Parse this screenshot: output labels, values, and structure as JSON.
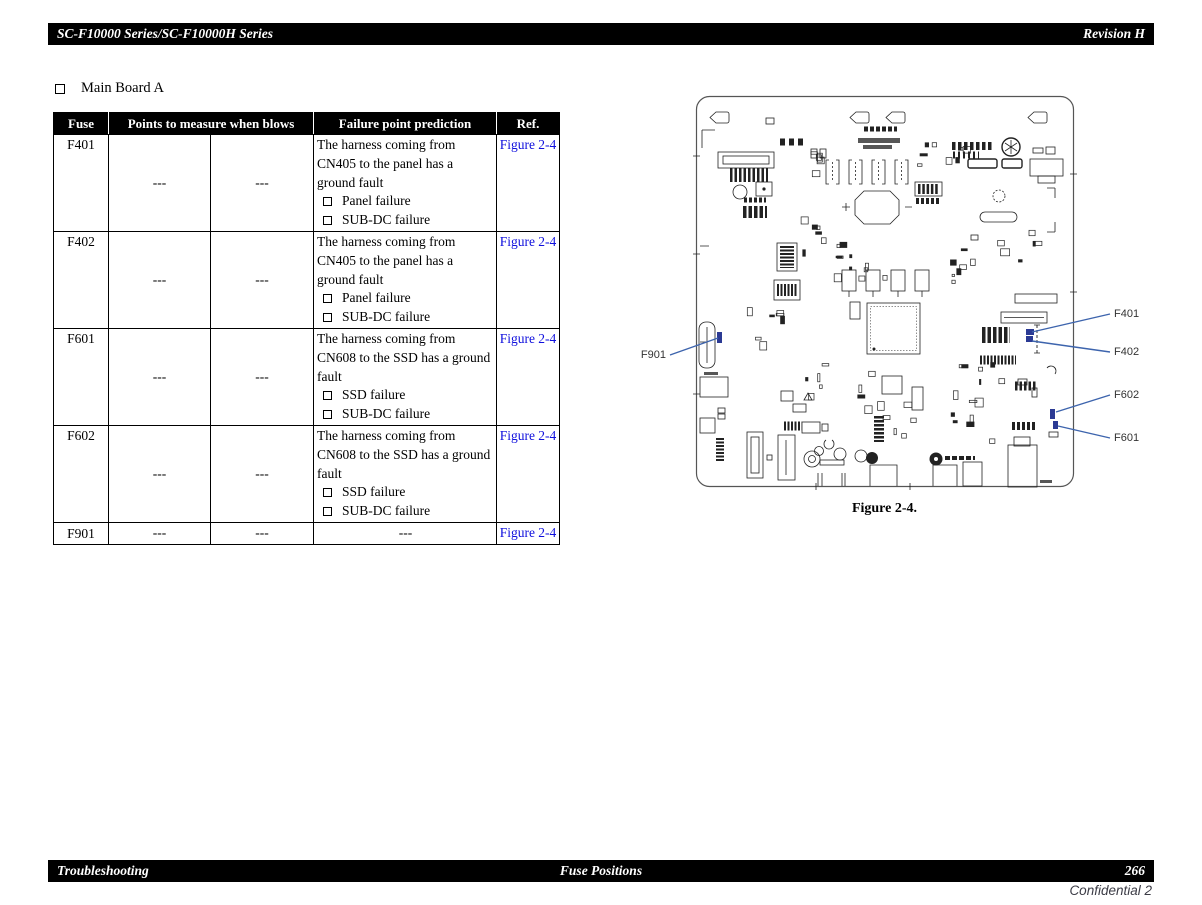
{
  "header": {
    "left": "SC-F10000 Series/SC-F10000H Series",
    "right": "Revision H"
  },
  "section": {
    "title": "Main Board A"
  },
  "table": {
    "headers": {
      "fuse": "Fuse",
      "points": "Points to measure when blows",
      "prediction": "Failure point prediction",
      "ref": "Ref."
    },
    "rows": [
      {
        "fuse": "F401",
        "measure_1": "---",
        "measure_2": "---",
        "prediction": "The harness coming from CN405 to the panel has a ground fault",
        "failures": [
          "Panel failure",
          "SUB-DC failure"
        ],
        "ref": "Figure 2-4"
      },
      {
        "fuse": "F402",
        "measure_1": "---",
        "measure_2": "---",
        "prediction": "The harness coming from CN405 to the panel has a ground fault",
        "failures": [
          "Panel failure",
          "SUB-DC failure"
        ],
        "ref": "Figure 2-4"
      },
      {
        "fuse": "F601",
        "measure_1": "---",
        "measure_2": "---",
        "prediction": "The harness coming from CN608 to the SSD has a ground fault",
        "failures": [
          "SSD failure",
          "SUB-DC failure"
        ],
        "ref": "Figure 2-4"
      },
      {
        "fuse": "F602",
        "measure_1": "---",
        "measure_2": "---",
        "prediction": "The harness coming from CN608 to the SSD has a ground fault",
        "failures": [
          "SSD failure",
          "SUB-DC failure"
        ],
        "ref": "Figure 2-4"
      },
      {
        "fuse": "F901",
        "measure_1": "---",
        "measure_2": "---",
        "prediction": "---",
        "failures": [],
        "ref": "Figure 2-4"
      }
    ]
  },
  "figure": {
    "caption": "Figure 2-4.",
    "callouts": {
      "f901": "F901",
      "f401": "F401",
      "f402": "F402",
      "f602": "F602",
      "f601": "F601"
    }
  },
  "footer": {
    "left": "Troubleshooting",
    "center": "Fuse Positions",
    "page": "266",
    "confidential": "Confidential 2"
  },
  "colors": {
    "link_blue": "#0f0fdd",
    "callout_blue": "#3d64ad",
    "fuse_blue": "#2b3a94",
    "bar_bg": "#000000"
  }
}
